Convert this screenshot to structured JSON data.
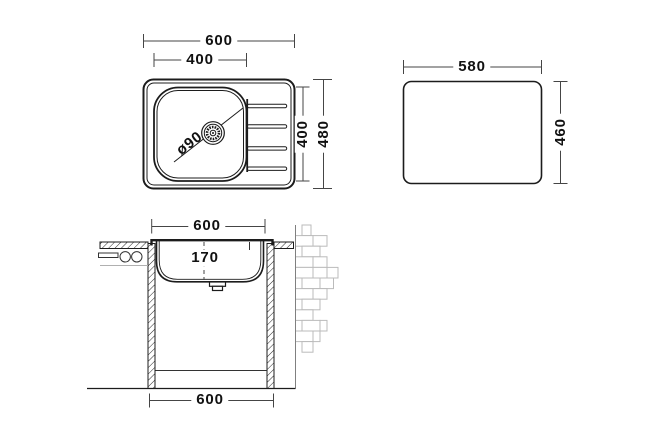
{
  "drawing": {
    "subject": "kitchen sink installation drawing",
    "colors": {
      "line": "#1c1c1c",
      "dim_line": "#454545",
      "text": "#111111",
      "brick_outline": "#bbbbbb",
      "light_gray_line": "#b0b0b0"
    },
    "top_view": {
      "overall_width": "600",
      "bowl_width": "400",
      "bowl_height": "400",
      "overall_height": "480",
      "drain_diameter": "ø90"
    },
    "cutout_view": {
      "width": "580",
      "height": "460"
    },
    "section_view": {
      "top_width": "600",
      "bowl_depth": "170",
      "bottom_width": "600"
    }
  }
}
